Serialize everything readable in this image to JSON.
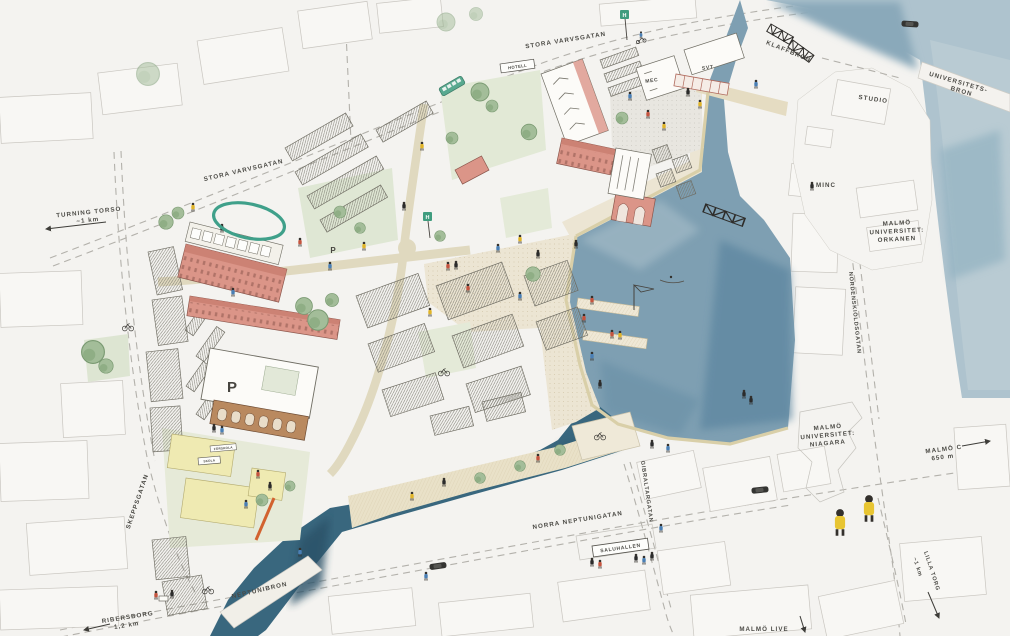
{
  "labels": {
    "stora_varvsgatan_west": "STORA VARVSGATAN",
    "stora_varvsgatan_north": "STORA VARVSGATAN",
    "turning_torso": "TURNING TORSO",
    "turning_torso_dist": "~1 km",
    "klaffbron": "KLAFFBRON",
    "universitetsbron_line1": "UNIVERSITETS-",
    "universitetsbron_line2": "BRON",
    "studio": "STUDIO",
    "minc": "MINC",
    "orkanen_line1": "MALMÖ",
    "orkanen_line2": "UNIVERSITET:",
    "orkanen_line3": "ORKANEN",
    "nordenskioldsgatan": "NORDENSKIÖLDSGATAN",
    "niagara_line1": "MALMÖ",
    "niagara_line2": "UNIVERSITET:",
    "niagara_line3": "NIAGARA",
    "malmo_c": "MALMÖ C",
    "malmo_c_dist": "650 m",
    "lilla_torg": "LILLA TORG",
    "lilla_torg_dist": "~1 km",
    "malmo_live": "MALMÖ LIVE",
    "saluhallen": "SALUHALLEN",
    "norra_neptunigatan": "NORRA NEPTUNIGATAN",
    "gibraltargatan": "GIBRALTARGATAN",
    "skeppsgatan": "SKEPPSGATAN",
    "neptunibron": "NEPTUNIBRON",
    "ribersborg": "RIBERSBORG",
    "ribersborg_dist": "1,2 km",
    "hotell": "HOTELL",
    "mec": "MEC",
    "svt": "SVT",
    "forskola": "FÖRSKOLA",
    "skola": "SKOLA",
    "parking": "P",
    "bus_stop": "H"
  },
  "colors": {
    "paper": "#f4f3f0",
    "water_basin": "#7e9fb2",
    "water_sea": "#9db6c4",
    "water_canal": "#35617a",
    "accent_green": "#3fa08a",
    "building_red": "#db9588",
    "building_yellow": "#efeab2",
    "road_tan": "#e5dcc2",
    "text": "#4b4a45"
  }
}
